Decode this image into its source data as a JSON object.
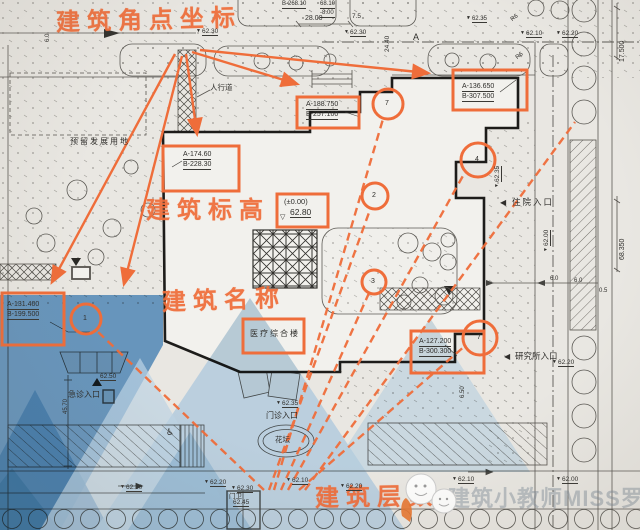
{
  "accent": "#ef6d3a",
  "handwritten": {
    "corner_coords": "建筑角点坐标",
    "elevation": "建筑标高",
    "name": "建筑名称",
    "floors": "建筑层数"
  },
  "coords": {
    "nw_a": "A-174.60",
    "nw_b": "B-228.30",
    "n_a": "A-188.750",
    "n_b": "B-257.100",
    "ne_a": "A-136.650",
    "ne_b": "B-307.500",
    "sw_a": "A-131.400",
    "sw_b": "B-199.500",
    "se_a": "A-127.200",
    "se_b": "B-300.300",
    "top_cut_a": "68.10",
    "top_cut_b": "-8.00",
    "top_cut_c": "B-268.10"
  },
  "elevation_box": {
    "relative": "(±0.00)",
    "absolute": "62.80"
  },
  "building_name": "医疗综合楼",
  "floors": {
    "c1": "1",
    "c2": "2",
    "c3": "3",
    "c4": "4",
    "c7": "7",
    "c7b": "7"
  },
  "labels": {
    "sidewalk": "人行道",
    "reserved": "预留发展用地",
    "inpatient": "住院入口",
    "research": "研究所入口",
    "emergency": "急诊入口",
    "outpatient": "门诊入口",
    "flowerbed": "花坛",
    "gatehouse": "门卫"
  },
  "spots": {
    "s1": "62.30",
    "s2": "62.30",
    "s3": "62.10",
    "s4": "62.20",
    "s5": "62.35",
    "s6": "62.35",
    "s7": "62.00",
    "s8": "62.20",
    "s9": "62.50",
    "s10": "62.30",
    "s11": "62.20",
    "s12": "62.30",
    "s13": "62.45",
    "s14": "62.10",
    "s15": "62.20",
    "s16": "62.10",
    "s17": "62.00",
    "s18": "62.35"
  },
  "dims": {
    "d28": "28.00",
    "d75": "7.5",
    "d244": "24.40",
    "d175": "17.500",
    "d6835": "68.350",
    "d457": "45.70",
    "d65": "6.50",
    "d6a": "6.0",
    "d6b": "6.0",
    "d05": "0.5",
    "d6c": "6.0"
  },
  "grid": {
    "a": "A"
  },
  "radius": {
    "r1": "R6",
    "r2": "R6"
  },
  "icons": {
    "level_down": "▼",
    "level_up": "▲",
    "entry_left": "◀",
    "level_open": "▽",
    "accessible": "♿"
  },
  "watermark": {
    "text": "建筑小教师MISS罗"
  }
}
